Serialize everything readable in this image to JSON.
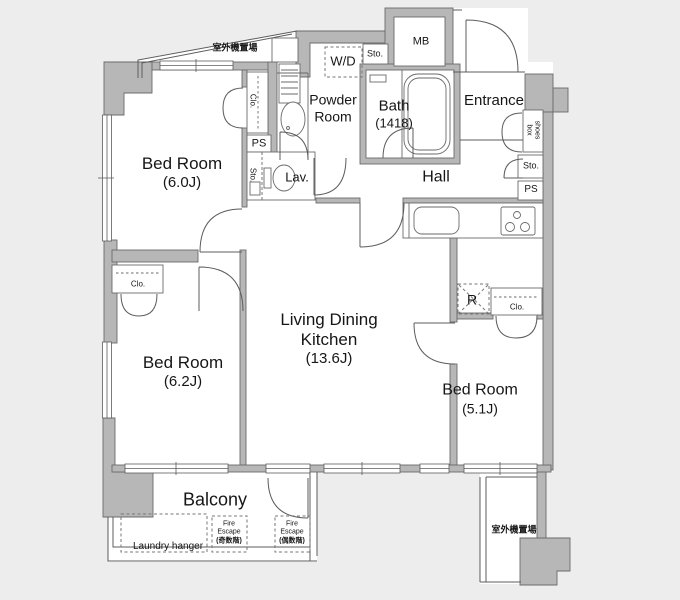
{
  "colors": {
    "background": "#ededed",
    "floor": "#ffffff",
    "wall": "#b7b7b7",
    "wall_border": "#6b6b6b",
    "line": "#5c5c5c",
    "text": "#161616"
  },
  "rooms": {
    "bedroom_60": {
      "name": "Bed Room",
      "size": "(6.0J)"
    },
    "bedroom_62": {
      "name": "Bed Room",
      "size": "(6.2J)"
    },
    "bedroom_51": {
      "name": "Bed Room",
      "size": "(5.1J)"
    },
    "ldk": {
      "line1": "Living Dining",
      "line2": "Kitchen",
      "size": "(13.6J)"
    },
    "bath": {
      "name": "Bath",
      "size": "(1418)"
    },
    "powder_room": {
      "line1": "Powder",
      "line2": "Room"
    },
    "hall": {
      "name": "Hall"
    },
    "entrance": {
      "name": "Entrance"
    },
    "lav": {
      "name": "Lav."
    },
    "balcony": {
      "name": "Balcony"
    }
  },
  "fixtures": {
    "washer_dryer": "W/D",
    "meter_box": "MB",
    "refrigerator": "R",
    "shoes_box_line1": "shoes",
    "shoes_box_line2": "box",
    "storage": "Sto.",
    "pipe_space": "PS",
    "closet": "Clo.",
    "laundry_hanger": "Laundry hanger",
    "outdoor_unit_area": "室外機置場",
    "fire_escape": {
      "line1": "Fire",
      "line2": "Escape",
      "odd_floors": "(奇数階)",
      "even_floors": "(偶数階)"
    }
  }
}
